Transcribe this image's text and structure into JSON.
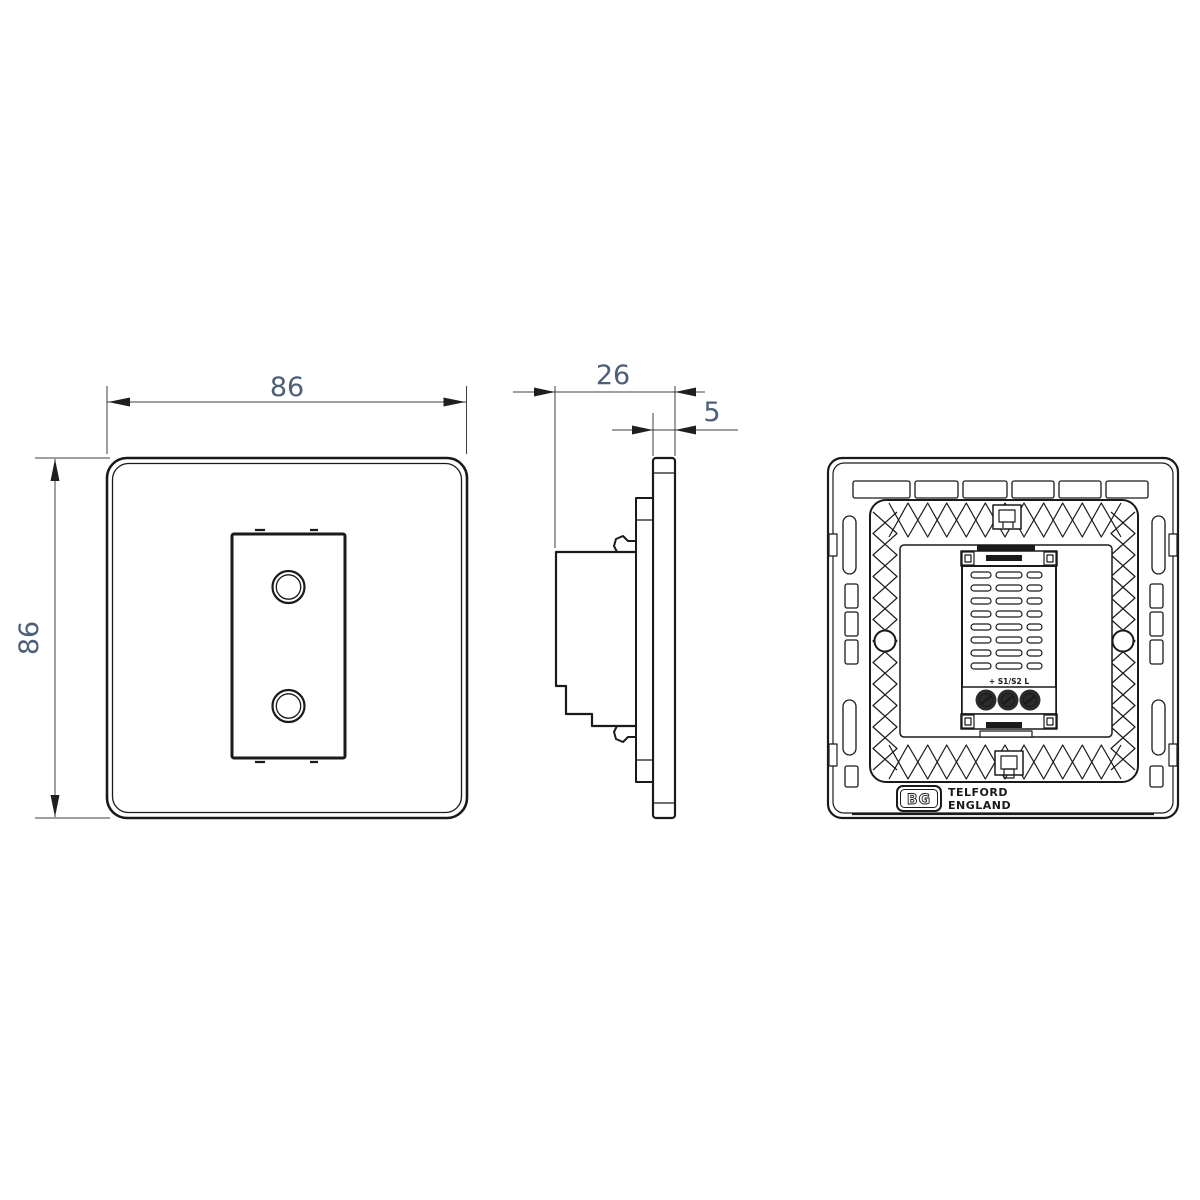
{
  "drawing": {
    "type": "technical-drawing",
    "subject": "touch dimmer light switch - three orthographic views",
    "colors": {
      "line": "#1a1a1a",
      "dimension_text": "#4d6078",
      "background": "#ffffff"
    },
    "views": {
      "front": {
        "label": "front-view",
        "width_dim": "86",
        "height_dim": "86"
      },
      "side": {
        "label": "side-view",
        "depth_dim": "26",
        "plate_thickness_dim": "5"
      },
      "back": {
        "label": "back-view",
        "terminal_label": "+ S1/S2 L",
        "logo": "BG",
        "origin_line1": "TELFORD",
        "origin_line2": "ENGLAND"
      }
    }
  }
}
